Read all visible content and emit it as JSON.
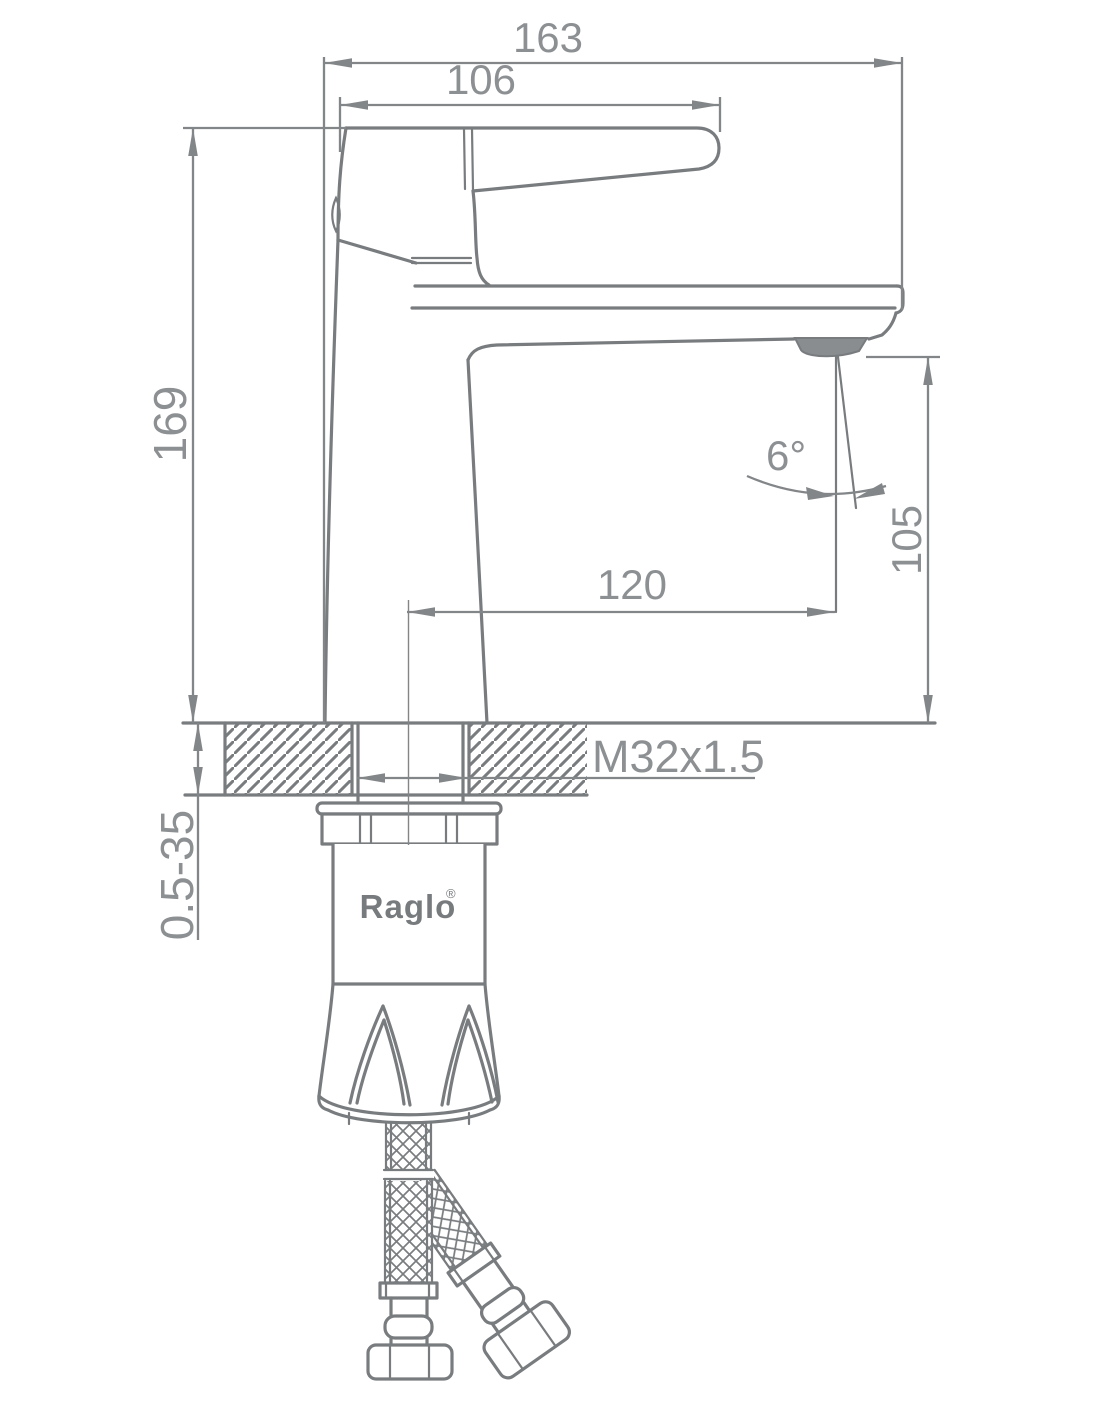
{
  "dimensions": {
    "overall_width": "163",
    "handle_width": "106",
    "overall_height": "169",
    "spout_reach": "120",
    "spout_height": "105",
    "spray_angle": "6°",
    "thread_spec": "M32x1.5",
    "deck_thickness_range": "0.5-35"
  },
  "brand": {
    "name": "Raglo",
    "mark": "®"
  },
  "colors": {
    "line": "#797c7f",
    "dimension": "#838688",
    "text": "#8d9093",
    "background": "#ffffff",
    "aerator_fill": "#8a8d90"
  }
}
